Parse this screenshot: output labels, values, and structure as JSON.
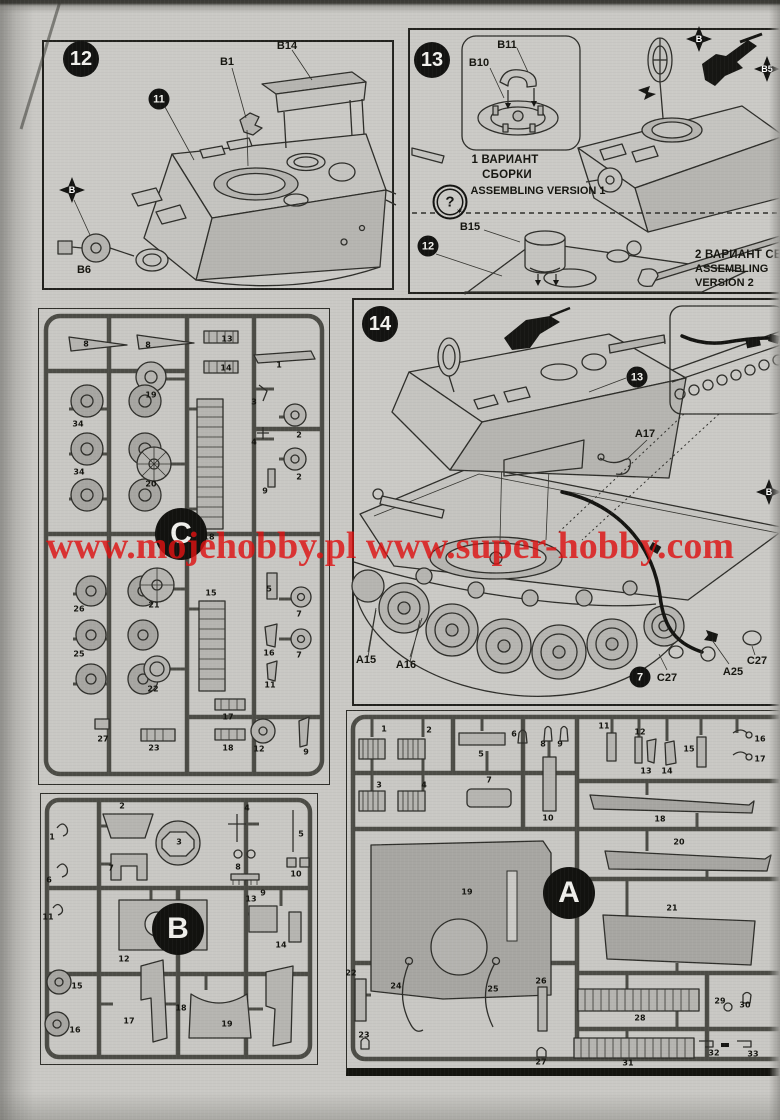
{
  "watermark": {
    "text": "www.mojehobby.pl www.super-hobby.com"
  },
  "steps": {
    "s12": {
      "badge": "12",
      "inner_badge": "11",
      "b14": "B14",
      "b1": "B1",
      "flag_b": "B",
      "b6": "B6"
    },
    "s13": {
      "badge": "13",
      "b11": "B11",
      "b10": "B10",
      "v1_ru1": "1 ВАРИАНТ",
      "v1_ru2": "СБОРКИ",
      "v1_en": "ASSEMBLING VERSION 1",
      "qmark": "?",
      "qstar": "✶",
      "inner_badge": "12",
      "b15": "B15",
      "v2_ru": "2 ВАРИАНТ СБОРКИ",
      "v2_en1": "ASSEMBLING",
      "v2_en2": "VERSION 2",
      "flag_b": "B",
      "flag_b5": "B5"
    },
    "s14": {
      "badge": "14",
      "turret_badge": "13",
      "a17": "A17",
      "a15": "A15",
      "a16": "A16",
      "wire_badge": "7",
      "c27_left": "C27",
      "a25": "A25",
      "c27_right": "C27",
      "flag_b": "B"
    }
  },
  "sprues": {
    "c": {
      "letter": "C",
      "parts": [
        "8",
        "8",
        "13",
        "14",
        "1",
        "19",
        "34",
        "34",
        "20",
        "18",
        "3",
        "4",
        "2",
        "2",
        "9",
        "26",
        "25",
        "21",
        "22",
        "15",
        "5",
        "16",
        "11",
        "7",
        "7",
        "27",
        "23",
        "17",
        "18",
        "12",
        "9"
      ]
    },
    "b": {
      "letter": "B",
      "parts": [
        "1",
        "2",
        "3",
        "4",
        "5",
        "6",
        "7",
        "8",
        "9",
        "10",
        "11",
        "12",
        "13",
        "14",
        "15",
        "16",
        "17",
        "18",
        "19"
      ]
    },
    "a": {
      "letter": "A",
      "parts": [
        "1",
        "2",
        "3",
        "4",
        "5",
        "6",
        "7",
        "8",
        "9",
        "10",
        "11",
        "12",
        "13",
        "14",
        "15",
        "16",
        "17",
        "18",
        "19",
        "20",
        "21",
        "22",
        "23",
        "24",
        "25",
        "26",
        "27",
        "28",
        "29",
        "30",
        "31",
        "32",
        "33"
      ]
    }
  }
}
